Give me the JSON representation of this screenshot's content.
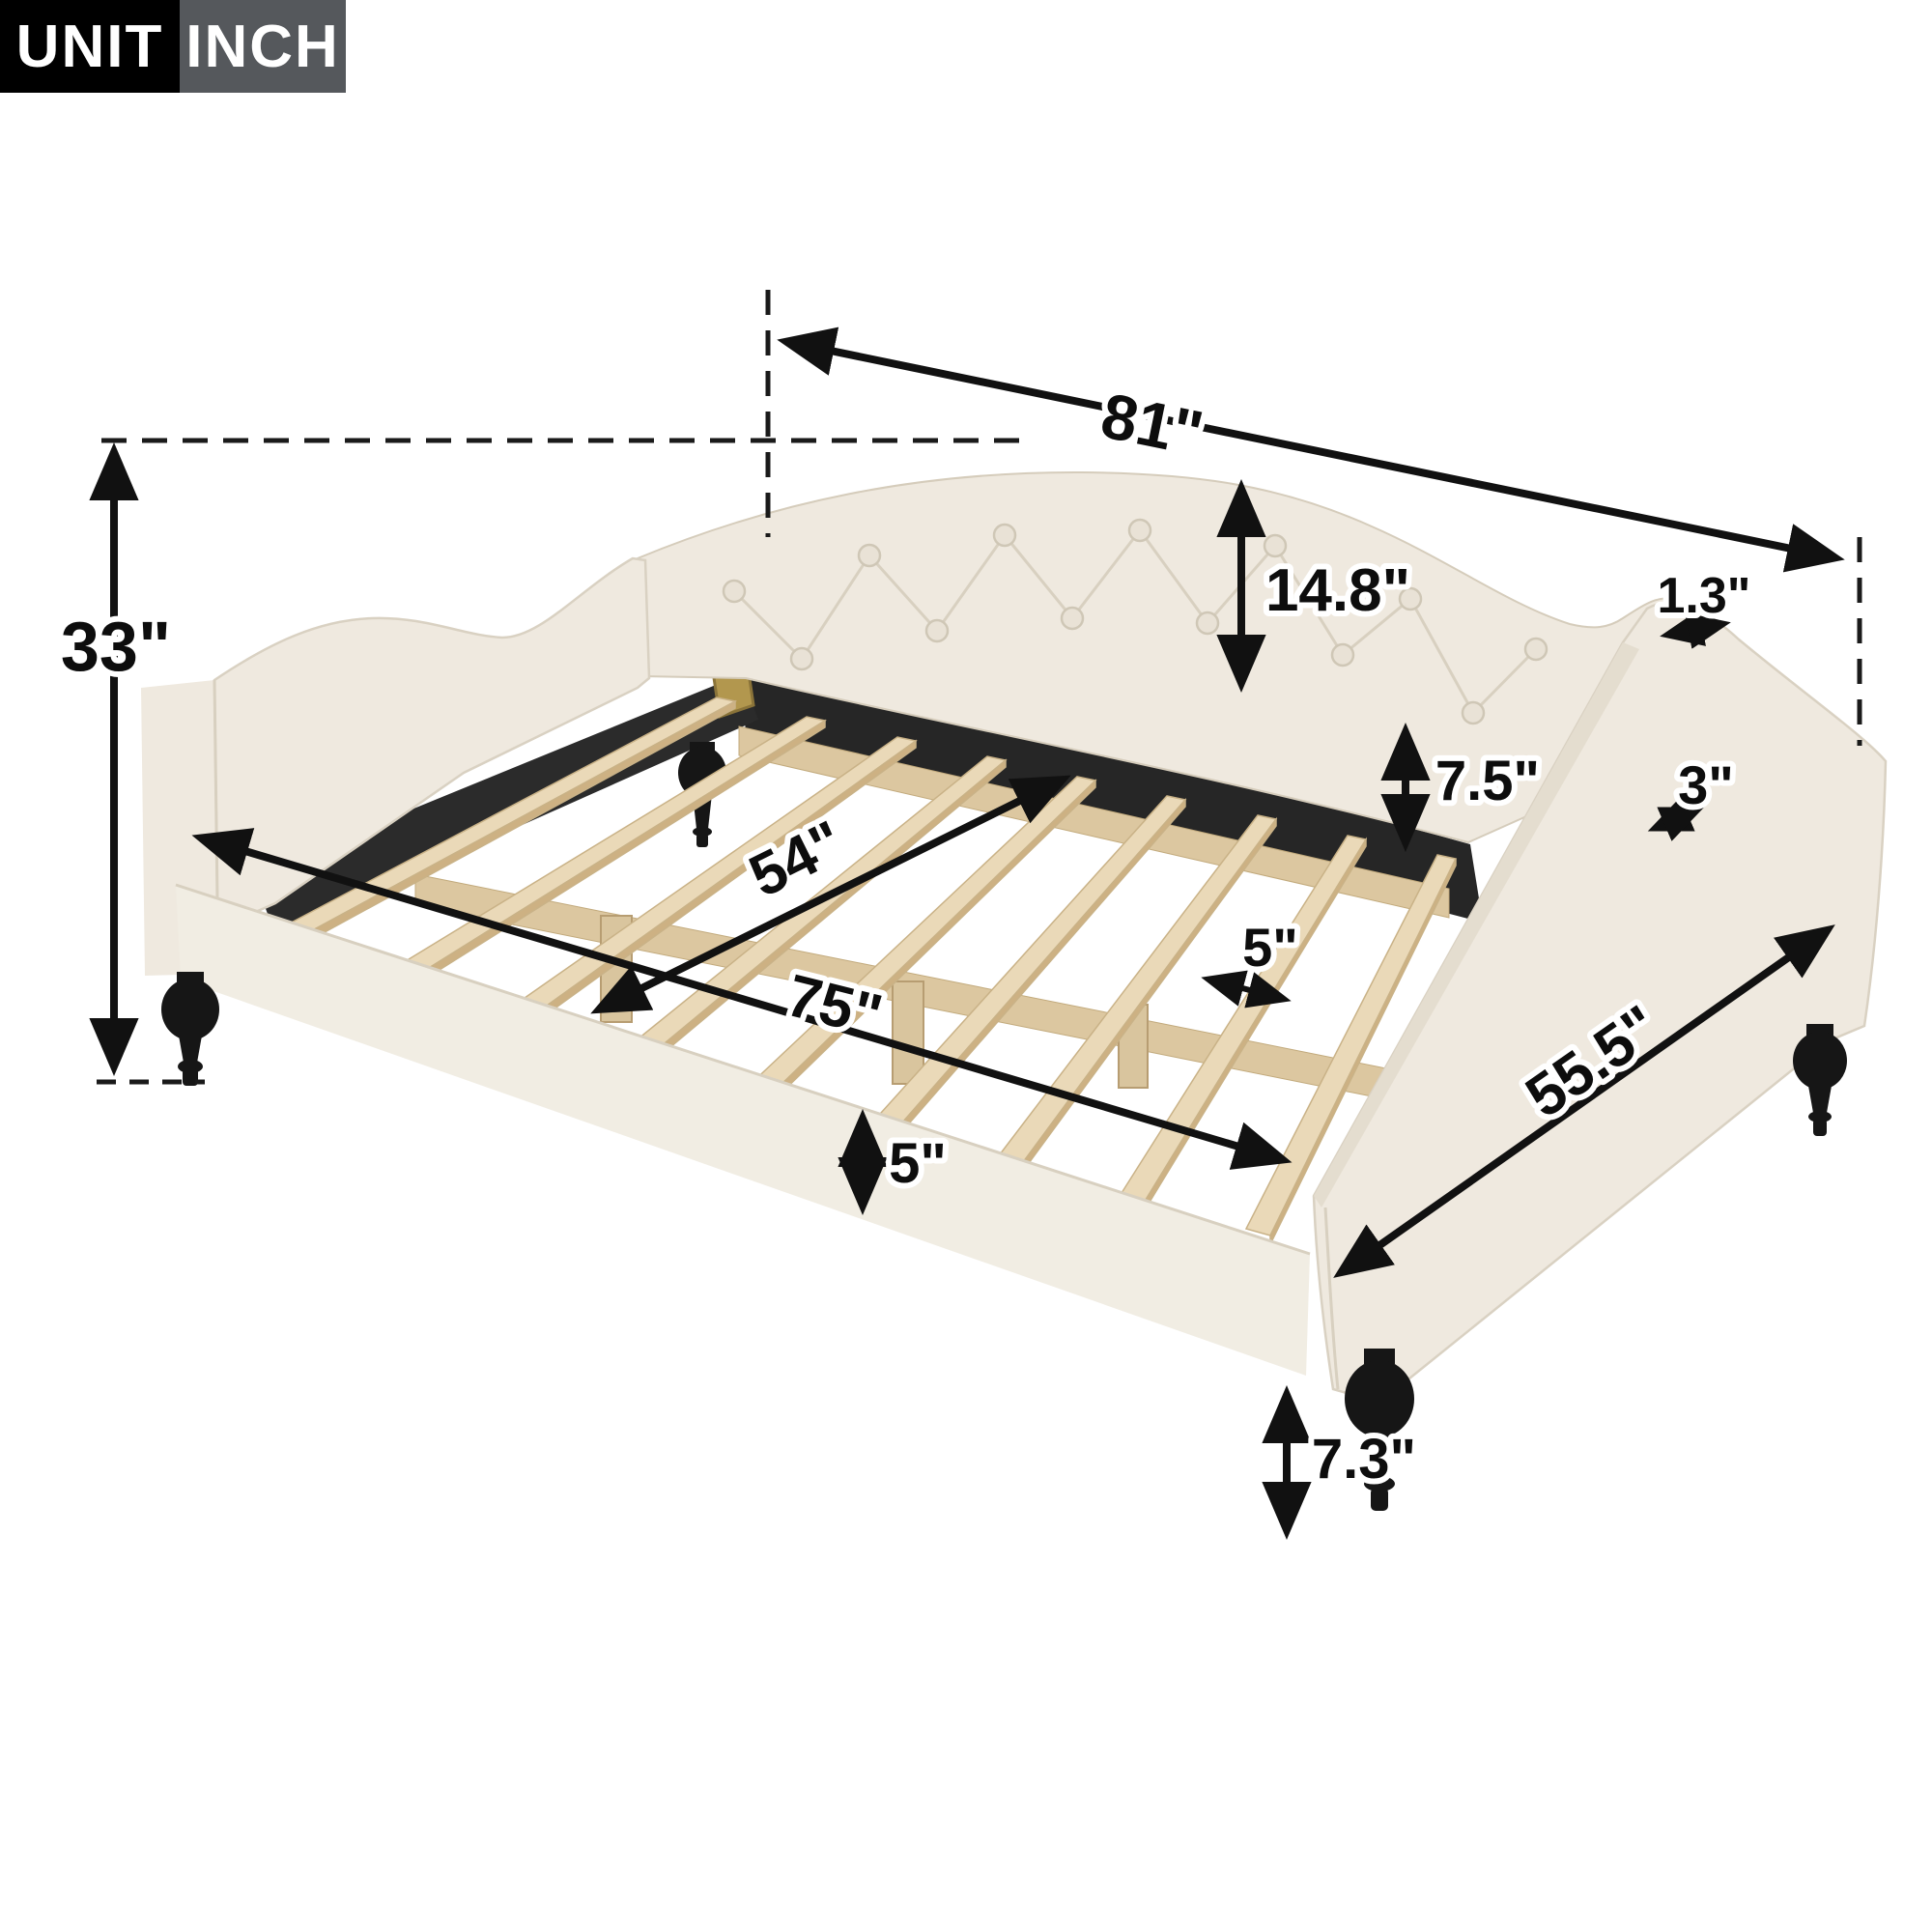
{
  "badge": {
    "unit_label": "UNIT",
    "unit_value": "INCH"
  },
  "dimensions": {
    "total_length": "81\"",
    "total_height": "33\"",
    "backrest_height": "14.8\"",
    "headboard_top_thickness": "1.3\"",
    "back_rail_height": "7.5\"",
    "arm_top_thickness": "3\"",
    "inner_width": "54\"",
    "inner_length": "75\"",
    "slat_spacing": "5\"",
    "front_rail_height": "5\"",
    "total_depth": "55.5\"",
    "leg_height": "7.3\""
  },
  "colors": {
    "fabric": "#efe9df",
    "wood_slat": "#ead9b8",
    "rail_black": "#262626",
    "leg_black": "#161616",
    "hinge_gold": "#b2974e",
    "dimension_line": "#111111",
    "badge_black": "#000000",
    "badge_gray": "#55585c"
  }
}
